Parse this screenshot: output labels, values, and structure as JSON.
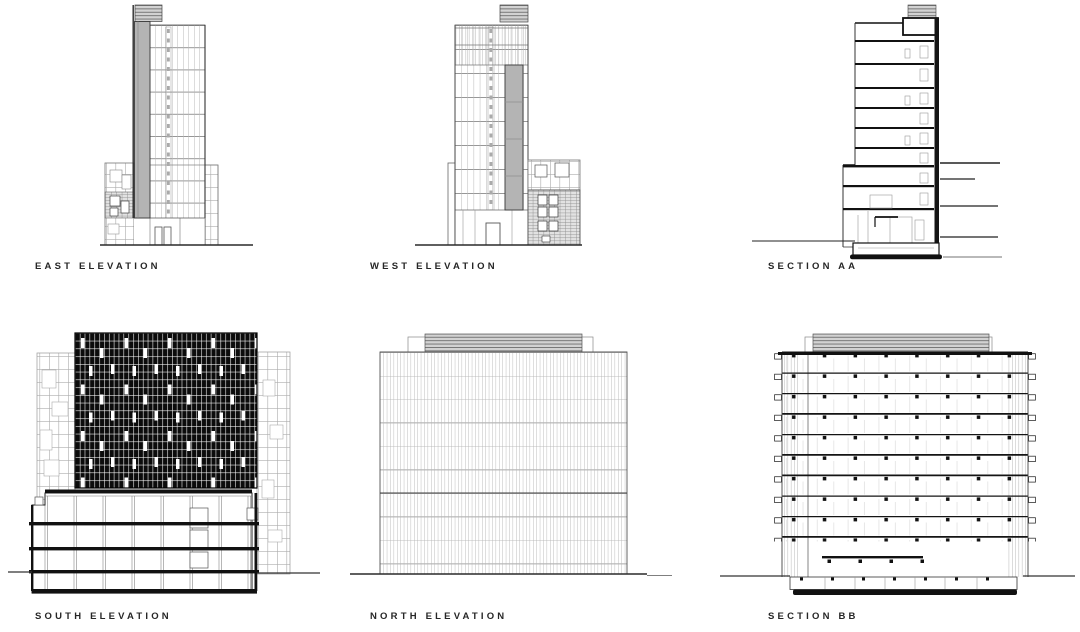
{
  "colors": {
    "ink": "#1a1a1a",
    "medium_line": "#777777",
    "light_line": "#b0b0b0",
    "core_band_gray": "#b4b4b4",
    "louver_gray": "#d2d2d2",
    "dark_screen": "#0d0d0d",
    "background": "#ffffff"
  },
  "panels": [
    {
      "id": "east-elevation",
      "label": "EAST ELEVATION"
    },
    {
      "id": "west-elevation",
      "label": "WEST ELEVATION"
    },
    {
      "id": "section-aa",
      "label": "SECTION AA"
    },
    {
      "id": "south-elevation",
      "label": "SOUTH ELEVATION"
    },
    {
      "id": "north-elevation",
      "label": "NORTH ELEVATION"
    },
    {
      "id": "section-bb",
      "label": "SECTION BB"
    }
  ]
}
